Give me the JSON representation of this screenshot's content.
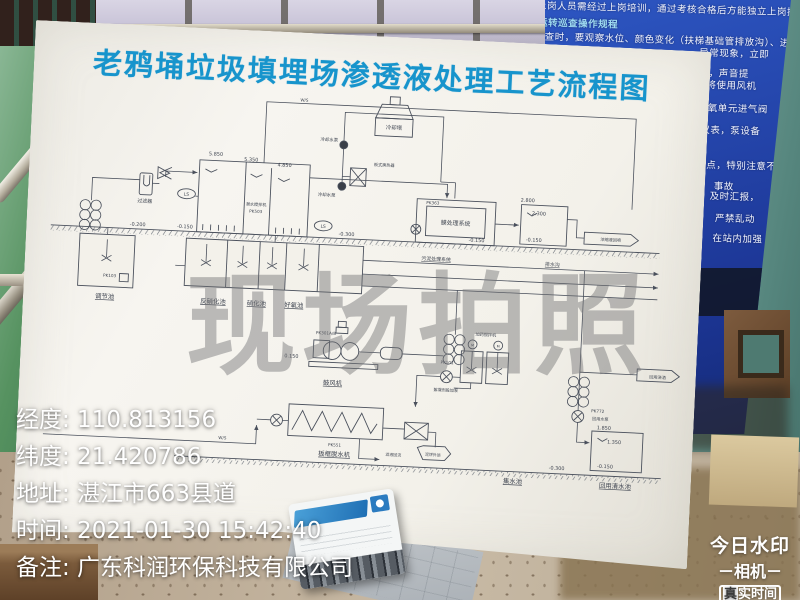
{
  "photo_overlay": {
    "center_watermark": "现场拍照",
    "separator": ": ",
    "fields": [
      {
        "label": "经度",
        "value": "110.813156"
      },
      {
        "label": "纬度",
        "value": "21.420786"
      },
      {
        "label": "地址",
        "value": "湛江市663县道"
      },
      {
        "label": "时间",
        "value": "2021-01-30 15:42:40"
      },
      {
        "label": "备注",
        "value": "广东科润环保科技有限公司"
      }
    ],
    "brand": {
      "line1": "今日水印",
      "line2": "－相机－",
      "badge_first": "真",
      "badge_rest": "实时间"
    }
  },
  "board": {
    "title": "老鸦埇垃圾填埋场渗透液处理工艺流程图",
    "title_color": "#1794cc",
    "diagram": {
      "labels": [
        {
          "t": "5.850",
          "x": 176,
          "y": 72,
          "s": 5
        },
        {
          "t": "5.350",
          "x": 212,
          "y": 76,
          "s": 5
        },
        {
          "t": "4.850",
          "x": 246,
          "y": 80,
          "s": 5
        },
        {
          "t": "-0.200",
          "x": 100,
          "y": 147,
          "s": 5
        },
        {
          "t": "-0.150",
          "x": 148,
          "y": 147,
          "s": 5
        },
        {
          "t": "-0.300",
          "x": 312,
          "y": 147,
          "s": 5
        },
        {
          "t": "-0.150",
          "x": 444,
          "y": 147,
          "s": 5
        },
        {
          "t": "2.800",
          "x": 494,
          "y": 104,
          "s": 5
        },
        {
          "t": "2.300",
          "x": 506,
          "y": 117,
          "s": 5
        },
        {
          "t": "-0.150",
          "x": 502,
          "y": 144,
          "s": 5
        },
        {
          "t": "0.150",
          "x": 262,
          "y": 273,
          "s": 5
        },
        {
          "t": "1.850",
          "x": 582,
          "y": 331,
          "s": 5
        },
        {
          "t": "1.350",
          "x": 593,
          "y": 345,
          "s": 5
        },
        {
          "t": "-0.150",
          "x": 585,
          "y": 370,
          "s": 5
        },
        {
          "t": "-0.300",
          "x": 536,
          "y": 374,
          "s": 5
        },
        {
          "t": "LS",
          "x": 148,
          "y": 114,
          "s": 4.5
        },
        {
          "t": "LS",
          "x": 288,
          "y": 140,
          "s": 4.5
        },
        {
          "t": "潜水搅拌机",
          "x": 219,
          "y": 121,
          "s": 4.2
        },
        {
          "t": "PK503",
          "x": 219,
          "y": 128,
          "s": 4.2
        },
        {
          "t": "PK363",
          "x": 398,
          "y": 111,
          "s": 4.2
        },
        {
          "t": "PK103",
          "x": 74,
          "y": 200,
          "s": 4.2
        },
        {
          "t": "PK301A/B",
          "x": 296,
          "y": 248,
          "s": 4.2
        },
        {
          "t": "PK101",
          "x": 420,
          "y": 272,
          "s": 4.2
        },
        {
          "t": "PK551",
          "x": 310,
          "y": 361,
          "s": 4.2
        },
        {
          "t": "PK772",
          "x": 575,
          "y": 314,
          "s": 4.2
        },
        {
          "t": "回用水泵",
          "x": 578,
          "y": 322,
          "s": 4.2
        },
        {
          "t": "过滤器",
          "x": 106,
          "y": 123,
          "s": 5
        },
        {
          "t": "冷却塔",
          "x": 355,
          "y": 37,
          "s": 5.5
        },
        {
          "t": "冷却水泵",
          "x": 290,
          "y": 52,
          "s": 4.5
        },
        {
          "t": "冷却水泵",
          "x": 290,
          "y": 108,
          "s": 4.5
        },
        {
          "t": "板式换热器",
          "x": 347,
          "y": 75,
          "s": 4.2
        },
        {
          "t": "膜处理系统",
          "x": 422,
          "y": 131,
          "s": 6
        },
        {
          "t": "调节池",
          "x": 70,
          "y": 222,
          "s": 6.5,
          "u": 1
        },
        {
          "t": "反硝化池",
          "x": 180,
          "y": 222,
          "s": 6.5,
          "u": 1
        },
        {
          "t": "硝化池",
          "x": 224,
          "y": 222,
          "s": 6.5,
          "u": 1
        },
        {
          "t": "好氧池",
          "x": 262,
          "y": 222,
          "s": 6.5,
          "u": 1
        },
        {
          "t": "污泥处理系统",
          "x": 404,
          "y": 168,
          "s": 5,
          "u": 1
        },
        {
          "t": "排水沟",
          "x": 522,
          "y": 168,
          "s": 5,
          "u": 1
        },
        {
          "t": "鼓风机",
          "x": 305,
          "y": 299,
          "s": 6.5,
          "u": 1
        },
        {
          "t": "板框脱水机",
          "x": 310,
          "y": 371,
          "s": 6.5,
          "u": 1
        },
        {
          "t": "加药搅拌机",
          "x": 458,
          "y": 242,
          "s": 4.2
        },
        {
          "t": "絮凝剂投加泵",
          "x": 420,
          "y": 300,
          "s": 4.2
        },
        {
          "t": "泥饼外运",
          "x": 410,
          "y": 366,
          "s": 4
        },
        {
          "t": "滤液回流",
          "x": 370,
          "y": 368,
          "s": 4
        },
        {
          "t": "浓缩液回喷",
          "x": 580,
          "y": 140,
          "s": 4.2
        },
        {
          "t": "回用浇洒",
          "x": 634,
          "y": 277,
          "s": 4.2
        },
        {
          "t": "回用清水池",
          "x": 596,
          "y": 390,
          "s": 6.5,
          "u": 1
        },
        {
          "t": "集水池",
          "x": 492,
          "y": 390,
          "s": 6.5,
          "u": 1
        },
        {
          "t": "W/S",
          "x": 263,
          "y": 13,
          "s": 4.2
        },
        {
          "t": "W/S",
          "x": 196,
          "y": 359,
          "s": 4.2
        },
        {
          "t": "M",
          "x": 445,
          "y": 253,
          "s": 3.5
        },
        {
          "t": "M",
          "x": 471,
          "y": 253,
          "s": 3.5
        }
      ]
    }
  },
  "wall_sign": {
    "rows": [
      {
        "x": -40,
        "y": 1,
        "t": "9、新上岗人员需经过上岗培训，通过考核合格后方能独立上岗操作"
      },
      {
        "x": -32,
        "y": 18,
        "t": "二、运转巡查操作规程",
        "hl": true
      },
      {
        "x": -55,
        "y": 32,
        "t": "每次巡回检查时，要观察水位、颜色变化（扶梯基础管排放沟）、进水"
      },
      {
        "x": 150,
        "y": 44,
        "t": "异常现象，立即"
      },
      {
        "x": 140,
        "y": 64,
        "t": "混流，声音提"
      },
      {
        "x": 128,
        "y": 76,
        "t": "时，先将使用风机"
      },
      {
        "x": 150,
        "y": 99,
        "t": "好氧单元进气阀"
      },
      {
        "x": 153,
        "y": 121,
        "t": "仪表，泵设备"
      },
      {
        "x": 160,
        "y": 156,
        "t": "点，特别注意不"
      },
      {
        "x": 168,
        "y": 177,
        "t": "事故"
      },
      {
        "x": 164,
        "y": 187,
        "t": "及时汇报，"
      },
      {
        "x": 170,
        "y": 209,
        "t": "严禁乱动"
      },
      {
        "x": 168,
        "y": 229,
        "t": "在站内加强"
      }
    ]
  },
  "colors": {
    "title_blue": "#1794cc",
    "sign_blue": "#1c3594",
    "wall_green": "#4a8257",
    "wall_teal": "#5f8f87",
    "watermark_grey": "rgba(112,112,116,0.45)"
  }
}
